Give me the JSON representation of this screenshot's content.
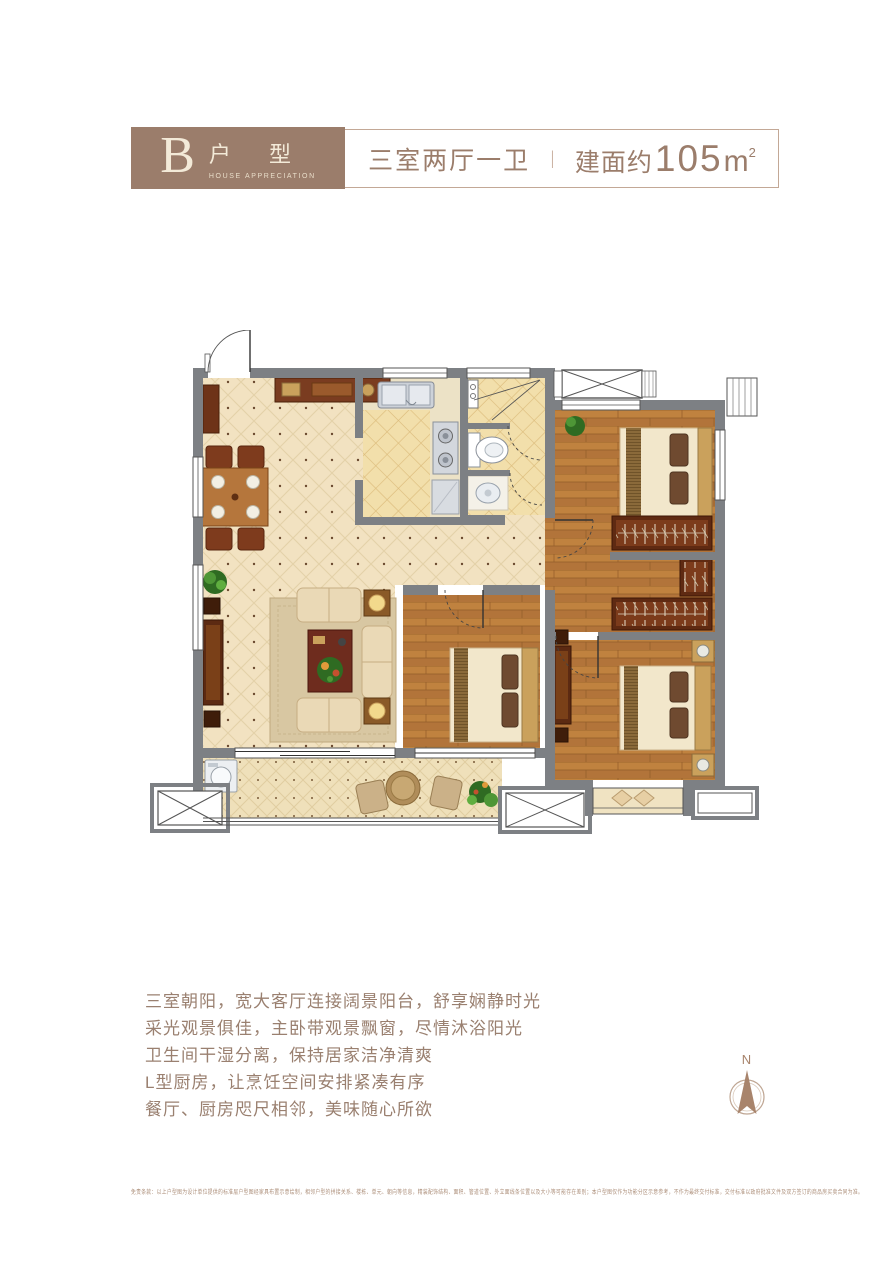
{
  "header": {
    "unit_letter": "B",
    "unit_title": "户 型",
    "unit_subtitle": "HOUSE APPRECIATION",
    "layout": "三室两厅一卫",
    "divider": "|",
    "area_prefix": "建面约",
    "area_number": "105",
    "area_unit": "m",
    "area_exponent": "2"
  },
  "description": {
    "lines": [
      "三室朝阳，宽大客厅连接阔景阳台，舒享娴静时光",
      "采光观景俱佳，主卧带观景飘窗，尽情沐浴阳光",
      "卫生间干湿分离，保持居家洁净清爽",
      "L型厨房，让烹饪空间安排紧凑有序",
      "餐厅、厨房咫尺相邻，美味随心所欲"
    ]
  },
  "compass": {
    "label": "N"
  },
  "disclaimer": {
    "text": "免责条款：以上户型图为设计单位提供的标准层户型图经家具布置示意绘制，相邻户型的拼接关系、楼栋、单元、朝向等信息，精装配饰结构、面积、管道位置、外立面线条位置以及大小等可能存在差别；本户型图仅作为功能分区示意参考，不作为最终交付标准，交付标准以政府批准文件及双方签订的商品房买卖合同为准。"
  },
  "colors": {
    "accent_brown": "#9b7d6b",
    "wall_gray": "#7d8084",
    "floor_beige": "#f2e2c1",
    "wood": "#c0823f"
  }
}
